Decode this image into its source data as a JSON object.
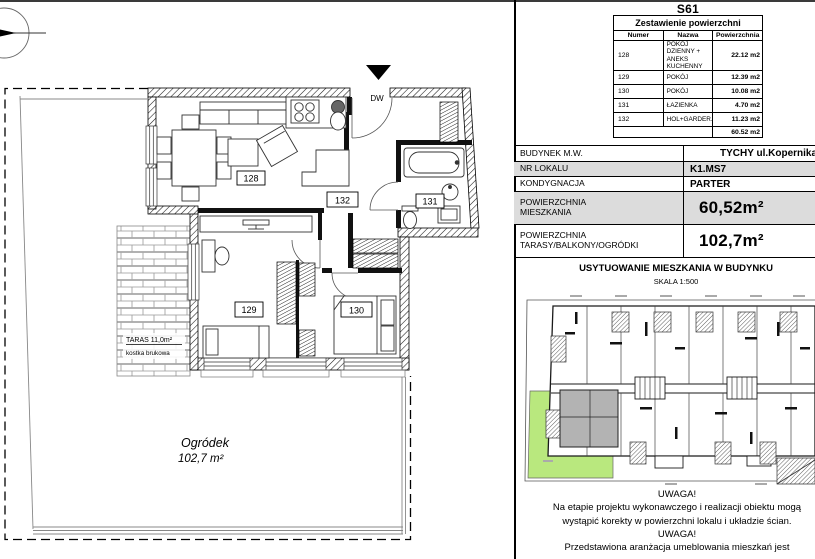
{
  "sheet": {
    "code": "S61"
  },
  "areas_table": {
    "title": "Zestawienie powierzchni",
    "columns": [
      "Numer",
      "Nazwa",
      "Powierzchnia"
    ],
    "rows": [
      {
        "numer": "128",
        "nazwa": "POKÓJ DZIENNY + ANEKS KUCHENNY",
        "powierzchnia": "22.12 m2"
      },
      {
        "numer": "129",
        "nazwa": "POKÓJ",
        "powierzchnia": "12.39 m2"
      },
      {
        "numer": "130",
        "nazwa": "POKÓJ",
        "powierzchnia": "10.08 m2"
      },
      {
        "numer": "131",
        "nazwa": "ŁAZIENKA",
        "powierzchnia": "4.70 m2"
      },
      {
        "numer": "132",
        "nazwa": "HOL+GARDER.",
        "powierzchnia": "11.23 m2"
      }
    ],
    "total": "60.52 m2"
  },
  "info_table": {
    "rows": [
      {
        "lines": [
          "BUDYNEK M.W."
        ],
        "value": "TYCHY ul.Kopernika"
      },
      {
        "lines": [
          "NR LOKALU"
        ],
        "value": "K1.MS7"
      },
      {
        "lines": [
          "KONDYGNACJA"
        ],
        "value": "PARTER"
      },
      {
        "lines": [
          "POWIERZCHNIA",
          "MIESZKANIA"
        ],
        "value": "60,52m²"
      },
      {
        "lines": [
          "POWIERZCHNIA",
          "TARASY/BALKONY/OGRÓDKI"
        ],
        "value": "102,7m²"
      }
    ]
  },
  "location": {
    "title": "USYTUOWANIE MIESZKANIA W BUDYNKU",
    "scale": "SKALA 1:500"
  },
  "notes": {
    "warn1": "UWAGA!",
    "line1": "Na etapie projektu wykonawczego i realizacji obiektu mogą",
    "line2": "wystąpić korekty w powierzchni lokalu i układzie ścian.",
    "warn2": "UWAGA!",
    "line3": "Przedstawiona aranżacja umeblowania mieszkań jest"
  },
  "plan": {
    "room_labels": {
      "living": "128",
      "bedroom1": "129",
      "bedroom2": "130",
      "bath": "131",
      "hall": "132"
    },
    "entrance_label": "DW",
    "terrace_label": "TARAS 11,0m²",
    "terrace_sub": "kostka brukowa",
    "garden_label": "Ogródek",
    "garden_area": "102,7 m²"
  },
  "colors": {
    "garden_green": "#b9e87e",
    "apartment_gray": "#b3b3b3",
    "table_row_gray": "#dcdcdc"
  }
}
